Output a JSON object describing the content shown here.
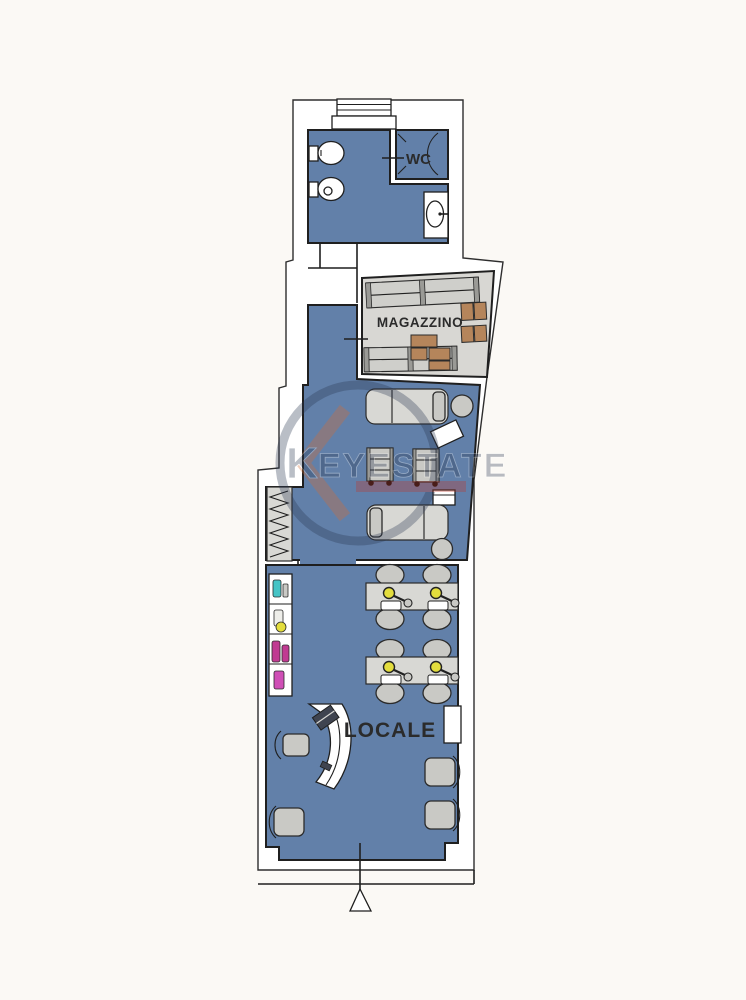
{
  "plan": {
    "rooms": {
      "wc": {
        "label": "WC"
      },
      "magazzino": {
        "label": "MAGAZZINO"
      },
      "locale": {
        "label": "LOCALE"
      }
    },
    "watermark": {
      "letter": "K",
      "text": "EYESTATE"
    },
    "symbols": [
      "window",
      "entrance-arrow",
      "shower",
      "toilet",
      "bidet",
      "sink",
      "massage-bed",
      "trolley",
      "stool",
      "manicure-table",
      "manicure-lamp",
      "product-shelf",
      "coat-rack",
      "storage-rack",
      "boxes",
      "reception-desk",
      "office-chair",
      "armchair",
      "wall-niche"
    ]
  },
  "palette": {
    "paper": "#fbf9f5",
    "room-fill": "#6280a9",
    "storage-fill": "#d8d7d3",
    "wall": "#1f1f1f",
    "furniture": "#c9c9c5",
    "furniture-light": "#d8d8d4",
    "box-brown": "#b5855b",
    "lamp-yellow": "#e3dd3d",
    "bottle-cyan": "#46c4c6",
    "bottle-magenta": "#c03a92",
    "bottle-violet": "#cf4fb6",
    "watermark-navy": "#2a3752",
    "watermark-orange": "#d96b2f",
    "watermark-red": "#c0392b"
  }
}
